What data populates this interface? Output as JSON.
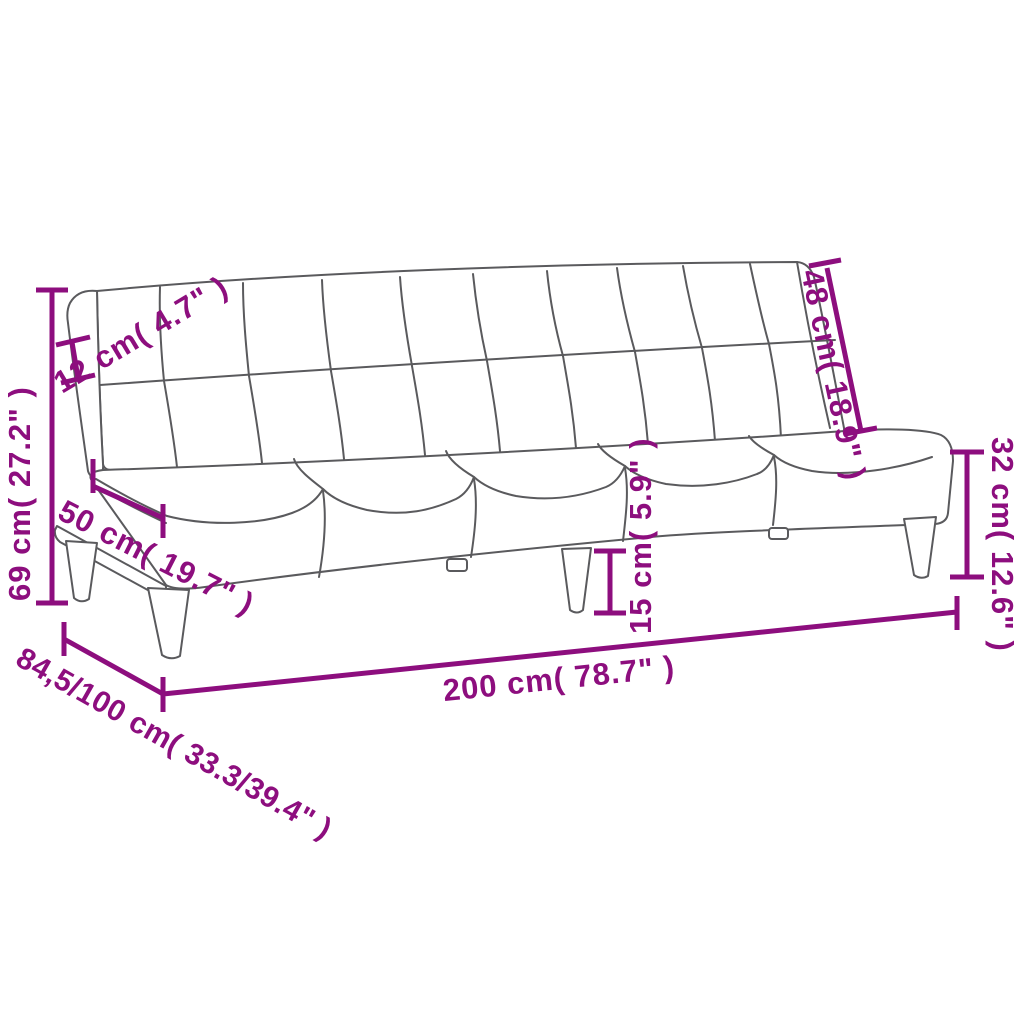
{
  "page": {
    "background": "#FFFFFF"
  },
  "diagram": {
    "type": "product-dimension-line-drawing",
    "subject": "armless sofa bed (futon) with tufted backrest, pillowy seat, wooden base rail and four tapered legs",
    "accent_color": "#8D0E7E",
    "outline_color": "#5A5A5D",
    "labels": {
      "overall_height": "69 cm( 27.2\" )",
      "backrest_thickness": "12 cm( 4.7\" )",
      "seat_depth": "50 cm( 19.7\" )",
      "backrest_height": "48 cm( 18.9\" )",
      "seat_height": "32 cm( 12.6\" )",
      "leg_height": "15 cm( 5.9\" )",
      "overall_width": "200 cm( 78.7\" )",
      "overall_depth": "84,5/100 cm( 33.3/39.4\" )"
    }
  }
}
